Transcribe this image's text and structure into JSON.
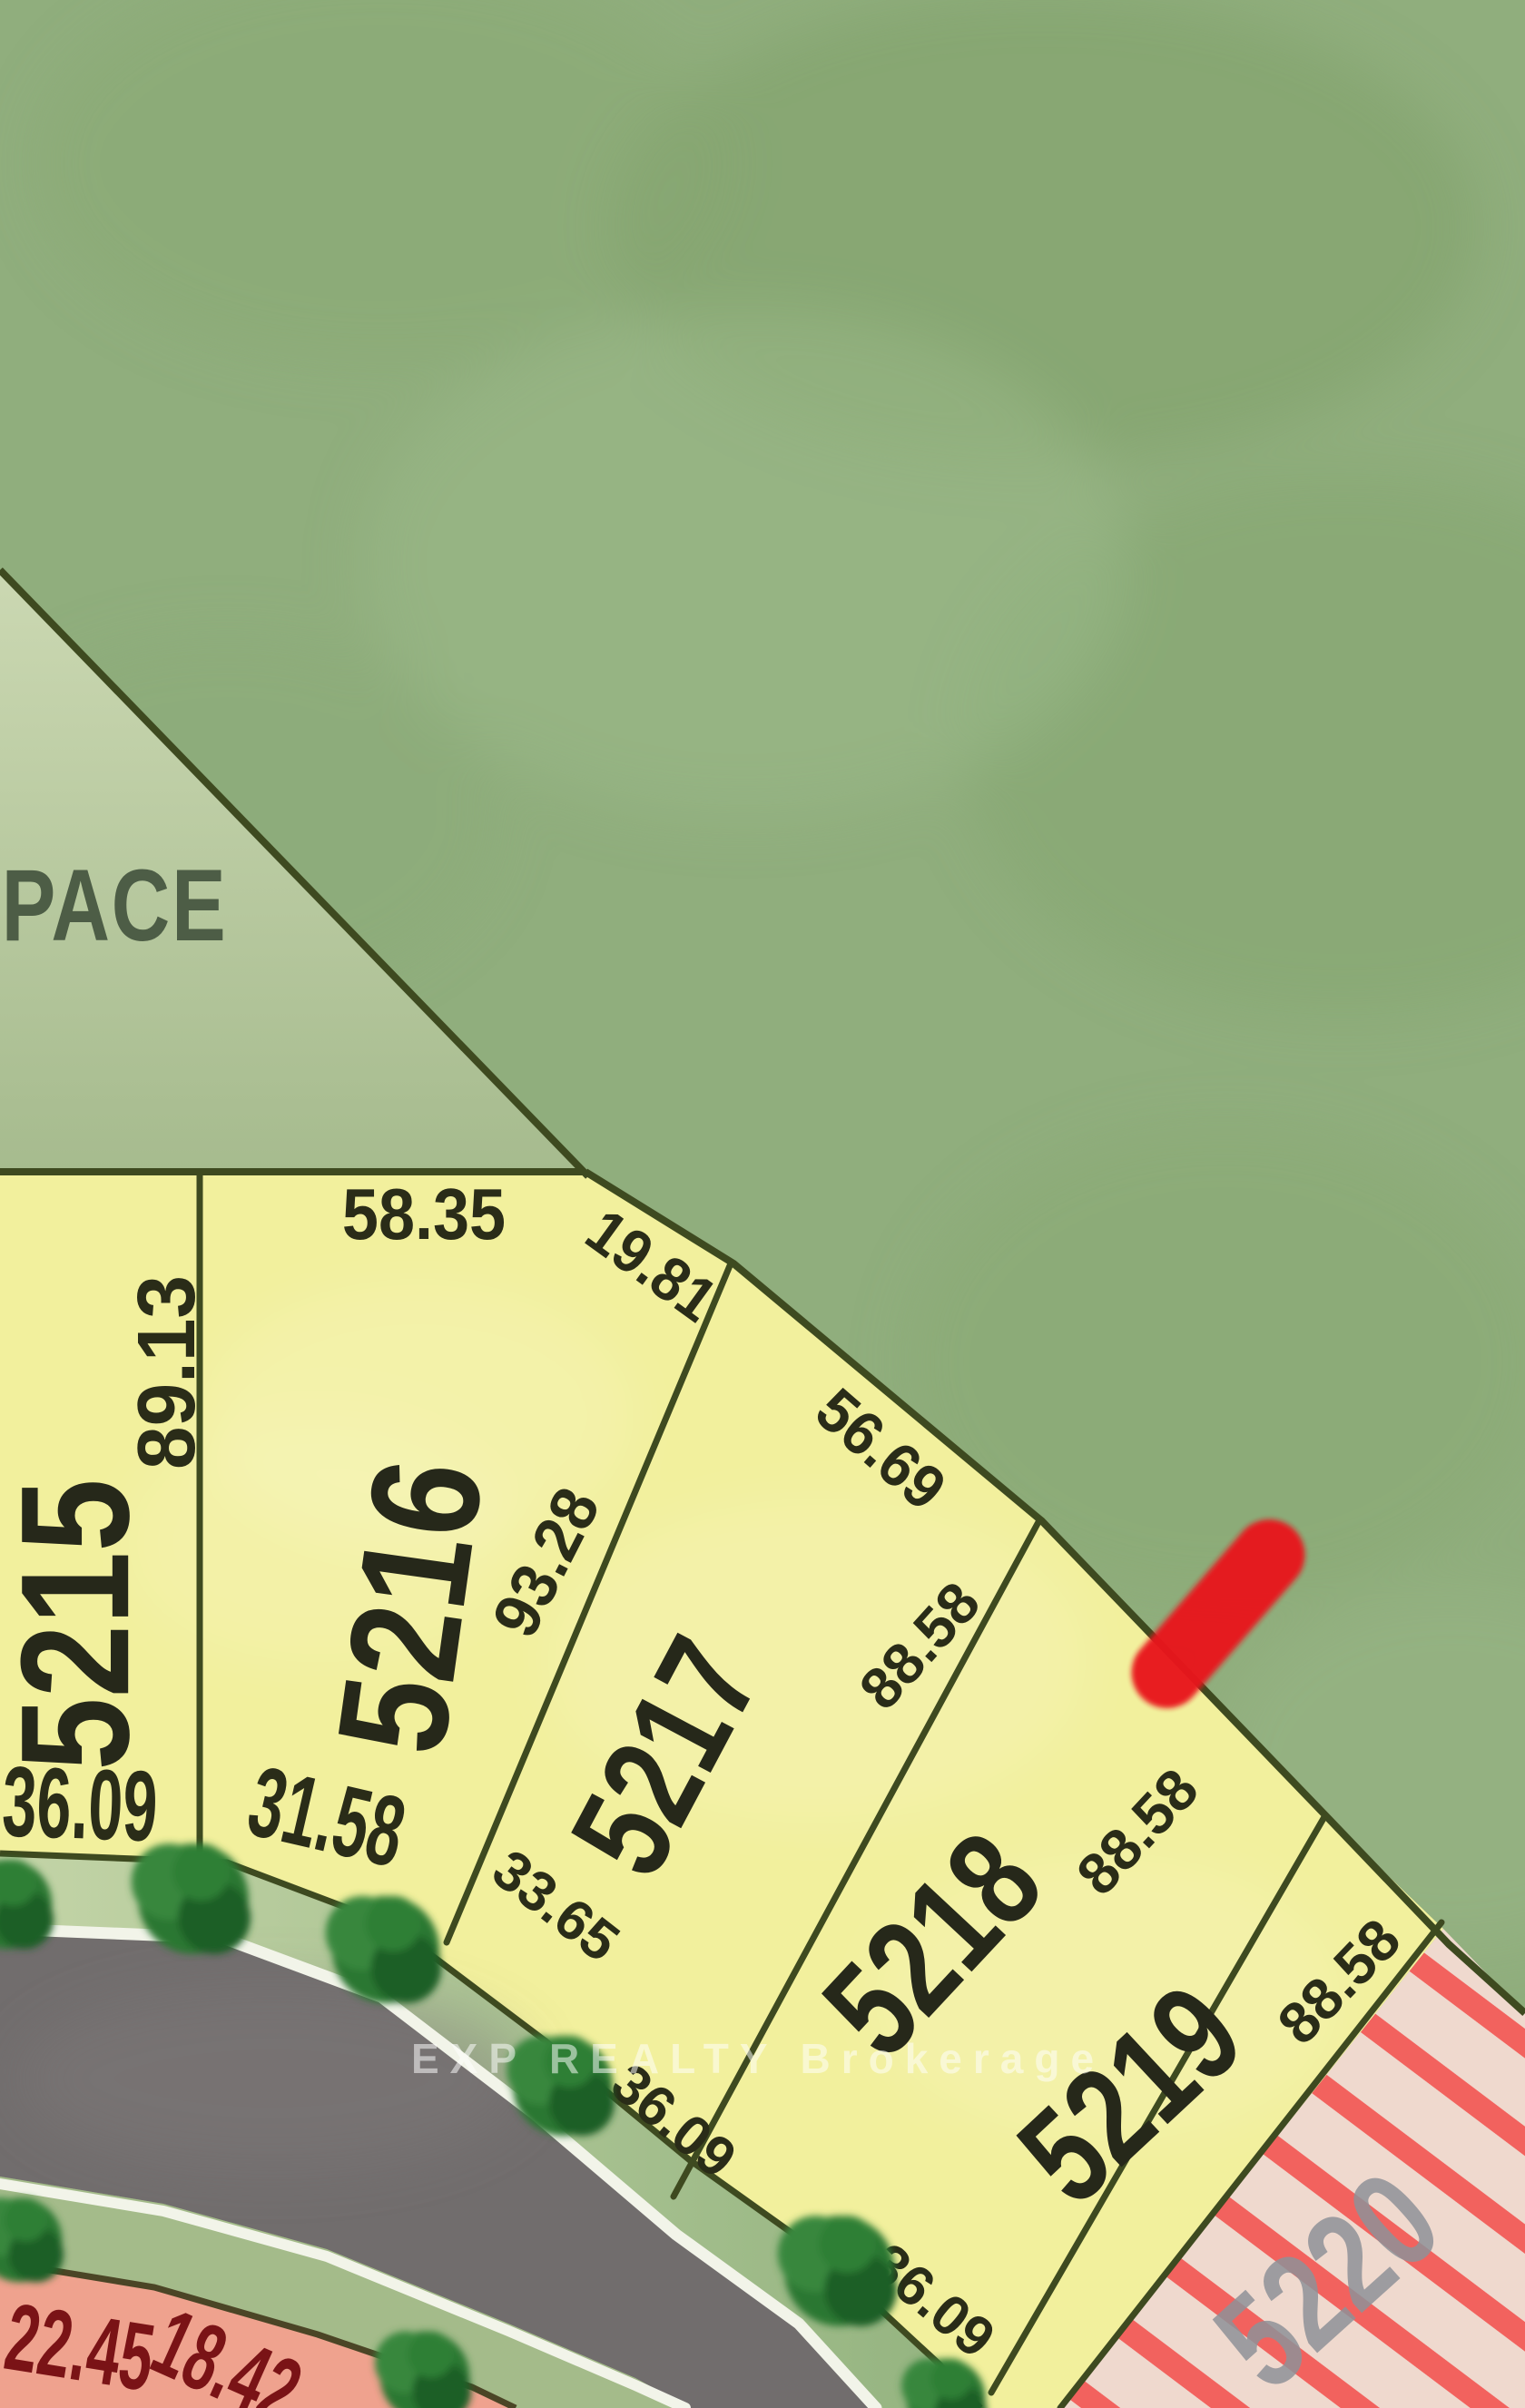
{
  "open_space": {
    "label": "PACE"
  },
  "watermark": {
    "text": "EXP REALTY Brokerage"
  },
  "lots": [
    {
      "number": "5215",
      "front": "36.09",
      "side": "89.13"
    },
    {
      "number": "5216",
      "top": "58.35",
      "corner": "19.81",
      "side": "93.28",
      "front": "31.58"
    },
    {
      "number": "5217",
      "top": "56.69",
      "side": "88.58",
      "front": "33.65"
    },
    {
      "number": "5218",
      "side": "88.58",
      "front": "36.09"
    },
    {
      "number": "5219",
      "side": "88.58",
      "front": "36.09"
    },
    {
      "number": "5220"
    }
  ],
  "street_parcel": {
    "dims": [
      "22.45",
      "18.42"
    ]
  },
  "marker": {
    "type": "red-highlight",
    "color": "#E8131C"
  },
  "colors": {
    "open_space": "#90AE7D",
    "open_space_light": "#C9D7B0",
    "lot_fill": "#F2F09D",
    "boundary_line": "#3E4A20",
    "road": "#716D6D",
    "grass_verge": "#AFC495",
    "sidewalk_line": "#F2F4E9",
    "tree": "#2B7732",
    "parcel_pink": "#EFA28E",
    "parcel_dim_text": "#7A1316",
    "hatch_bg": "#EFD9CE",
    "hatch_stripe": "#F2625E",
    "future_lot_text": "#8F9298",
    "highlight": "#E8131C"
  }
}
